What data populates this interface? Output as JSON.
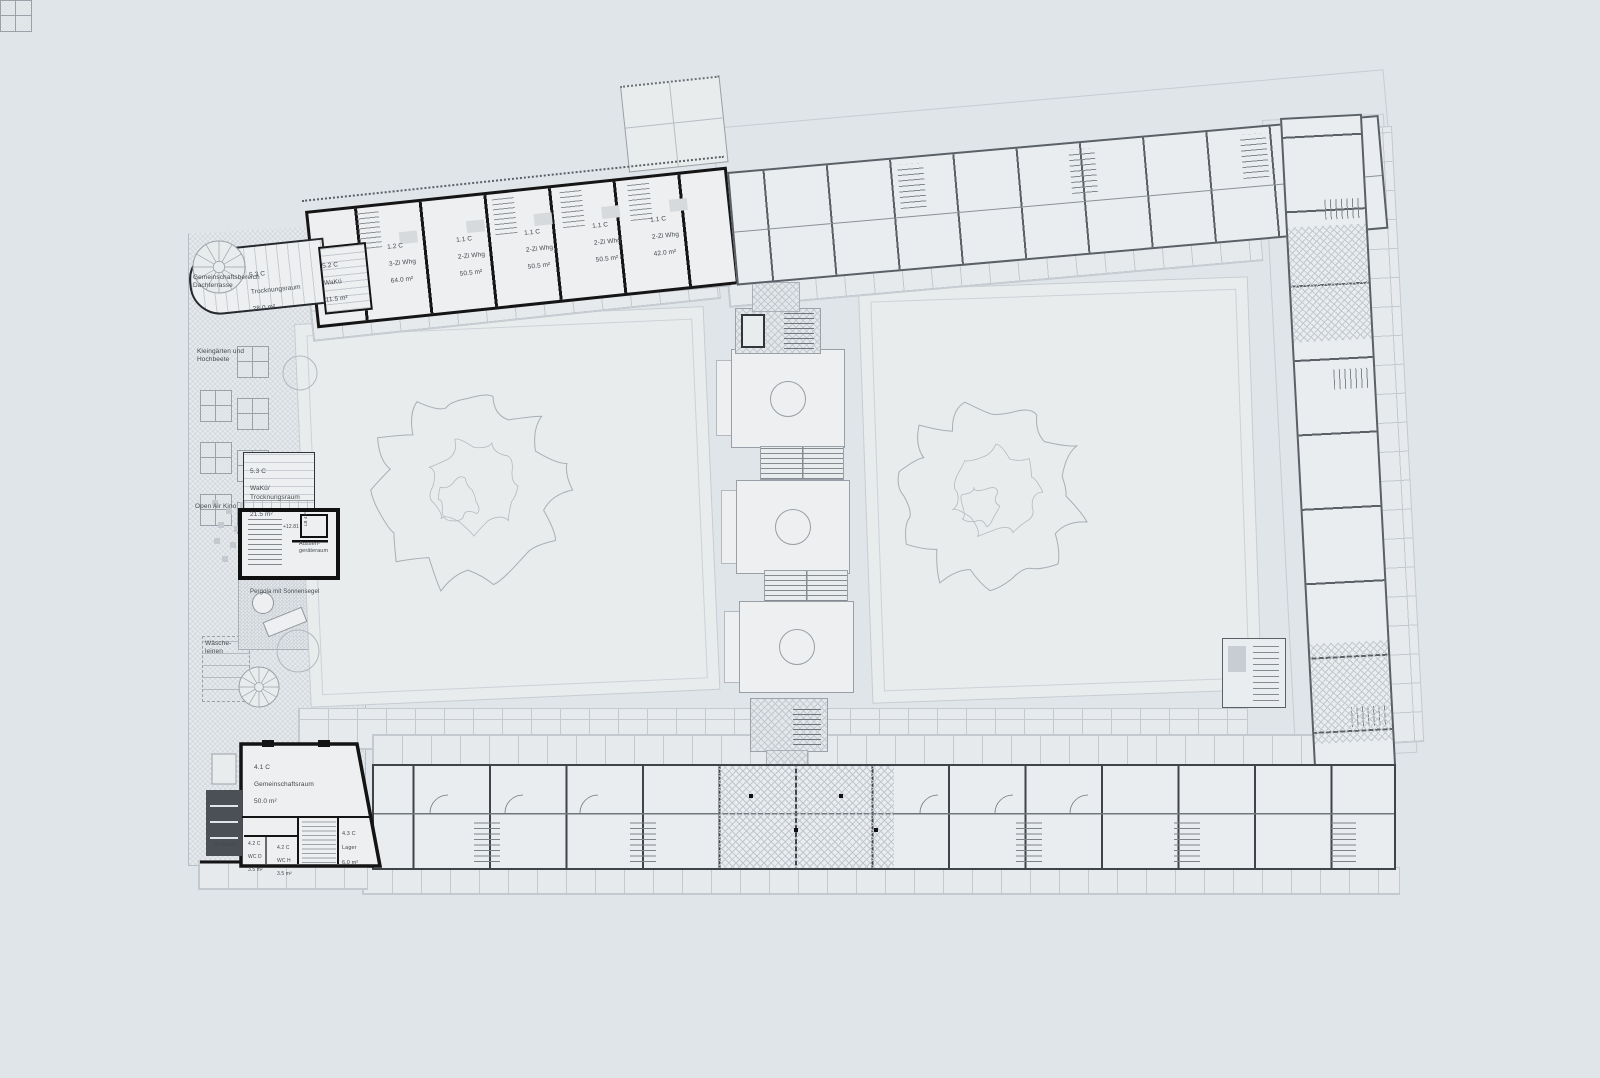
{
  "plan": {
    "colors": {
      "background": "#e0e5e9",
      "bold_wall": "#151515",
      "medium_wall": "#5a6066",
      "dark_wall": "#3f444a",
      "line": "#9aa1a8",
      "text": "#45494e"
    },
    "area_labels": {
      "gemeinschaftsbereich": "Gemeinschaftsbereich\nDachterrasse",
      "kleingaerten": "Kleingärten und\nHochbeete",
      "open_air_kino": "Open Air Kino",
      "pergola": "Pergola mit Sonnensegel",
      "waescheleinen": "Wäsche-\nleinen",
      "grillstelle": "Grillstelle",
      "aussengeraeteraum": "Aussen-\ngeräteraum",
      "level_mark": "+12.81",
      "lift_mark": "LB 4 P"
    },
    "rooms": [
      {
        "code": "5.3 C",
        "name": "Trocknungsraum",
        "area": "28.0 m²"
      },
      {
        "code": "5.2 C",
        "name": "WaKü",
        "area": "11.5 m²"
      },
      {
        "code": "1.2 C",
        "name": "3-Zi Whg",
        "area": "64.0 m²"
      },
      {
        "code": "1.1 C",
        "name": "2-Zi Whg",
        "area": "50.5 m²"
      },
      {
        "code": "1.1 C",
        "name": "2-Zi Whg",
        "area": "50.5 m²"
      },
      {
        "code": "1.1 C",
        "name": "2-Zi Whg",
        "area": "50.5 m²"
      },
      {
        "code": "1.1 C",
        "name": "2-Zi Whg",
        "area": "42.0 m²"
      },
      {
        "code": "5.3 C",
        "name": "WaKü/ Trocknungsraum",
        "area": "21.5 m²"
      },
      {
        "code": "4.1 C",
        "name": "Gemeinschaftsraum",
        "area": "50.0 m²"
      },
      {
        "code": "4.2 C",
        "name": "WC D",
        "area": "3.5 m²"
      },
      {
        "code": "4.2 C",
        "name": "WC H",
        "area": "3.5 m²"
      },
      {
        "code": "4.3 C",
        "name": "Lager",
        "area": "6.0 m²"
      }
    ]
  }
}
